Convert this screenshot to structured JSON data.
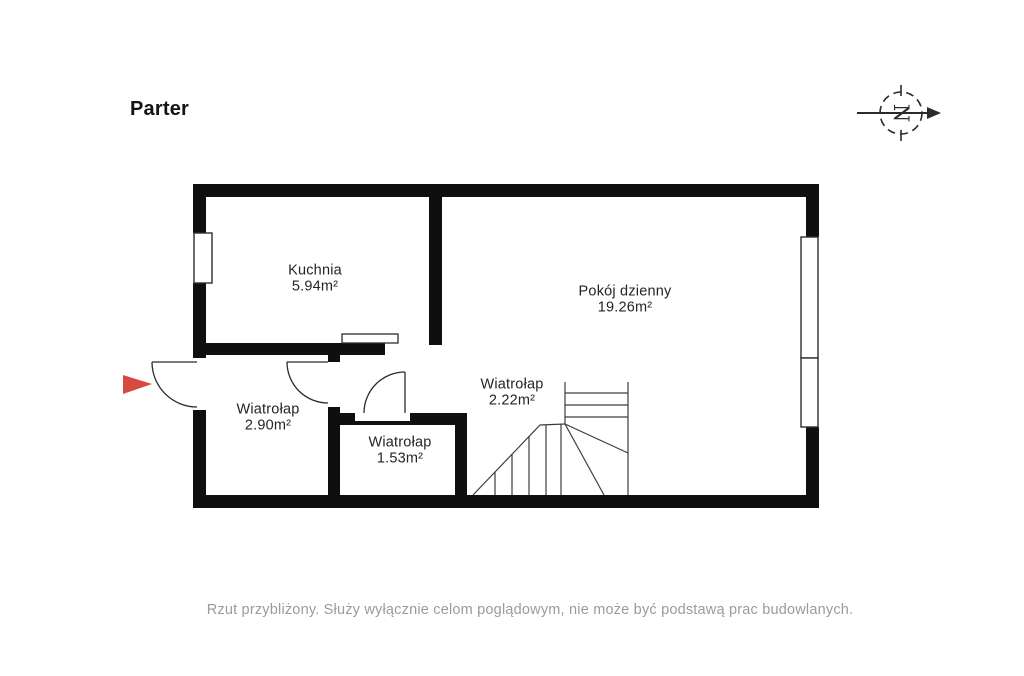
{
  "title": "Parter",
  "compass": {
    "letter": "N"
  },
  "rooms": {
    "kuchnia": {
      "name": "Kuchnia",
      "area": "5.94m²"
    },
    "pokoj_dzienny": {
      "name": "Pokój dzienny",
      "area": "19.26m²"
    },
    "wiatrolap_duzy": {
      "name": "Wiatrołap",
      "area": "2.90m²"
    },
    "wiatrolap_maly": {
      "name": "Wiatrołap",
      "area": "1.53m²"
    },
    "wiatrolap_hall": {
      "name": "Wiatrołap",
      "area": "2.22m²"
    }
  },
  "disclaimer": "Rzut przybliżony. Służy wyłącznie celom poglądowym, nie może być podstawą prac budowlanych.",
  "colors": {
    "wall": "#0f0f0f",
    "entrance_arrow": "#d8493f",
    "line": "#2b2b2b",
    "disclaimer_text": "#9b9b9b"
  }
}
